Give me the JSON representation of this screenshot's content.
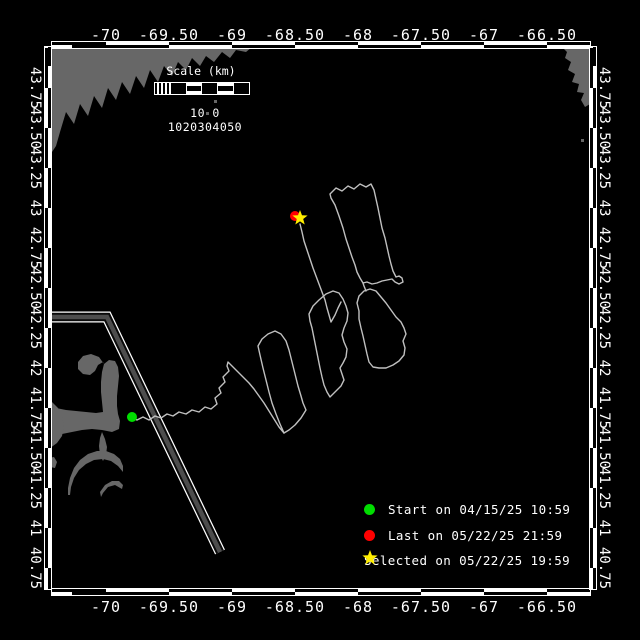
{
  "figure": {
    "background": "#000000",
    "frame_color": "#ffffff",
    "land_color": "#676767",
    "track_color": "#c0c0c0",
    "lane_color": "#4d4d4d",
    "start_color": "#00dd00",
    "last_color": "#ff0000",
    "selected_color": "#ffee00"
  },
  "axes": {
    "lon_ticks": [
      {
        "label": "-70",
        "x": 106
      },
      {
        "label": "-69.50",
        "x": 169
      },
      {
        "label": "-69",
        "x": 232
      },
      {
        "label": "-68.50",
        "x": 295
      },
      {
        "label": "-68",
        "x": 358
      },
      {
        "label": "-67.50",
        "x": 421
      },
      {
        "label": "-67",
        "x": 484
      },
      {
        "label": "-66.50",
        "x": 547
      }
    ],
    "lat_ticks": [
      {
        "label": "43.75",
        "y": 88
      },
      {
        "label": "43.50",
        "y": 128
      },
      {
        "label": "43.25",
        "y": 168
      },
      {
        "label": "43",
        "y": 208
      },
      {
        "label": "42.75",
        "y": 248
      },
      {
        "label": "42.50",
        "y": 288
      },
      {
        "label": "42.25",
        "y": 328
      },
      {
        "label": "42",
        "y": 368
      },
      {
        "label": "41.75",
        "y": 408
      },
      {
        "label": "41.50",
        "y": 448
      },
      {
        "label": "41.25",
        "y": 488
      },
      {
        "label": "41",
        "y": 528
      },
      {
        "label": "40.75",
        "y": 568
      }
    ]
  },
  "scalebar": {
    "title": "Scale (km)",
    "ticks_text": "10 0 1020304050"
  },
  "legend": {
    "entries": [
      {
        "marker": "circle",
        "color": "#00dd00",
        "label": "Start on 04/15/25 10:59"
      },
      {
        "marker": "circle",
        "color": "#ff0000",
        "label": "Last on 05/22/25 21:59"
      },
      {
        "marker": "star",
        "color": "#ffee00",
        "label": "Selected on 05/22/25 19:59"
      }
    ]
  },
  "map": {
    "land_polygons": {
      "maine-coast": [
        [
          52,
          47
        ],
        [
          252,
          47
        ],
        [
          246,
          52
        ],
        [
          236,
          50
        ],
        [
          230,
          58
        ],
        [
          222,
          52
        ],
        [
          214,
          62
        ],
        [
          206,
          56
        ],
        [
          200,
          66
        ],
        [
          192,
          58
        ],
        [
          186,
          70
        ],
        [
          178,
          62
        ],
        [
          172,
          76
        ],
        [
          164,
          66
        ],
        [
          158,
          82
        ],
        [
          150,
          70
        ],
        [
          144,
          88
        ],
        [
          136,
          76
        ],
        [
          130,
          94
        ],
        [
          122,
          82
        ],
        [
          116,
          100
        ],
        [
          108,
          88
        ],
        [
          102,
          108
        ],
        [
          94,
          96
        ],
        [
          88,
          116
        ],
        [
          80,
          104
        ],
        [
          74,
          124
        ],
        [
          66,
          112
        ],
        [
          60,
          132
        ],
        [
          56,
          146
        ],
        [
          52,
          152
        ]
      ],
      "nova-scotia": [
        [
          562,
          47
        ],
        [
          590,
          47
        ],
        [
          590,
          104
        ],
        [
          585,
          107
        ],
        [
          581,
          100
        ],
        [
          584,
          93
        ],
        [
          577,
          92
        ],
        [
          579,
          84
        ],
        [
          572,
          82
        ],
        [
          575,
          74
        ],
        [
          568,
          70
        ],
        [
          571,
          62
        ],
        [
          565,
          58
        ],
        [
          567,
          52
        ]
      ],
      "cape-cod-arm": [
        [
          45,
          406
        ],
        [
          56,
          408
        ],
        [
          66,
          410
        ],
        [
          76,
          411
        ],
        [
          86,
          412
        ],
        [
          96,
          413
        ],
        [
          103,
          412
        ],
        [
          102,
          402
        ],
        [
          101,
          392
        ],
        [
          101,
          382
        ],
        [
          102,
          372
        ],
        [
          104,
          364
        ],
        [
          109,
          360
        ],
        [
          115,
          361
        ],
        [
          118,
          367
        ],
        [
          119,
          376
        ],
        [
          118,
          386
        ],
        [
          117,
          396
        ],
        [
          117,
          406
        ],
        [
          118,
          414
        ],
        [
          120,
          421
        ],
        [
          119,
          429
        ],
        [
          112,
          432
        ],
        [
          102,
          430
        ],
        [
          92,
          429
        ],
        [
          82,
          430
        ],
        [
          72,
          432
        ],
        [
          62,
          434
        ],
        [
          52,
          434
        ],
        [
          45,
          432
        ]
      ],
      "provincetown-hook": [
        [
          104,
          364
        ],
        [
          99,
          357
        ],
        [
          91,
          354
        ],
        [
          83,
          356
        ],
        [
          78,
          362
        ],
        [
          78,
          369
        ],
        [
          83,
          374
        ],
        [
          90,
          375
        ],
        [
          95,
          371
        ],
        [
          98,
          365
        ],
        [
          103,
          362
        ]
      ],
      "mainland-shore": [
        [
          45,
          398
        ],
        [
          52,
          402
        ],
        [
          58,
          408
        ],
        [
          62,
          416
        ],
        [
          64,
          426
        ],
        [
          62,
          436
        ],
        [
          57,
          443
        ],
        [
          50,
          448
        ],
        [
          45,
          450
        ]
      ],
      "monomoy": [
        [
          102,
          432
        ],
        [
          105,
          439
        ],
        [
          107,
          447
        ],
        [
          106,
          455
        ],
        [
          103,
          461
        ],
        [
          100,
          455
        ],
        [
          99,
          446
        ],
        [
          100,
          438
        ]
      ],
      "island-arc": [
        [
          68,
          488
        ],
        [
          70,
          478
        ],
        [
          74,
          468
        ],
        [
          80,
          460
        ],
        [
          88,
          454
        ],
        [
          97,
          451
        ],
        [
          106,
          451
        ],
        [
          114,
          454
        ],
        [
          120,
          459
        ],
        [
          123,
          466
        ],
        [
          123,
          472
        ],
        [
          118,
          466
        ],
        [
          111,
          461
        ],
        [
          103,
          459
        ],
        [
          94,
          460
        ],
        [
          86,
          464
        ],
        [
          79,
          470
        ],
        [
          74,
          478
        ],
        [
          71,
          487
        ],
        [
          70,
          495
        ],
        [
          68,
          495
        ]
      ],
      "island-arc-2": [
        [
          100,
          492
        ],
        [
          105,
          485
        ],
        [
          112,
          481
        ],
        [
          119,
          481
        ],
        [
          123,
          485
        ],
        [
          122,
          489
        ],
        [
          115,
          485
        ],
        [
          108,
          487
        ],
        [
          103,
          493
        ],
        [
          101,
          497
        ]
      ],
      "islet": [
        [
          49,
          458
        ],
        [
          54,
          457
        ],
        [
          57,
          462
        ],
        [
          55,
          468
        ],
        [
          50,
          467
        ],
        [
          48,
          462
        ]
      ]
    },
    "islets": [
      [
        214,
        100
      ],
      [
        228,
        92
      ],
      [
        206,
        112
      ],
      [
        581,
        139
      ]
    ],
    "lane": [
      [
        52,
        317
      ],
      [
        107,
        317
      ],
      [
        220,
        552
      ]
    ],
    "track_paths": {
      "transit": [
        [
          132,
          417
        ],
        [
          137,
          420
        ],
        [
          143,
          417
        ],
        [
          149,
          420
        ],
        [
          155,
          416
        ],
        [
          161,
          418
        ],
        [
          167,
          414
        ],
        [
          173,
          416
        ],
        [
          179,
          412
        ],
        [
          186,
          414
        ],
        [
          192,
          410
        ],
        [
          199,
          412
        ],
        [
          205,
          407
        ],
        [
          211,
          409
        ],
        [
          217,
          404
        ],
        [
          215,
          398
        ],
        [
          221,
          393
        ],
        [
          219,
          388
        ],
        [
          225,
          382
        ],
        [
          223,
          377
        ],
        [
          229,
          371
        ],
        [
          227,
          366
        ],
        [
          228,
          362
        ],
        [
          233,
          367
        ],
        [
          238,
          372
        ],
        [
          243,
          377
        ],
        [
          249,
          383
        ],
        [
          254,
          389
        ],
        [
          259,
          396
        ],
        [
          264,
          403
        ],
        [
          269,
          411
        ],
        [
          274,
          419
        ],
        [
          279,
          427
        ],
        [
          284,
          433
        ]
      ],
      "loop1": [
        [
          284,
          433
        ],
        [
          280,
          424
        ],
        [
          276,
          414
        ],
        [
          272,
          403
        ],
        [
          269,
          392
        ],
        [
          266,
          380
        ],
        [
          263,
          368
        ],
        [
          260,
          355
        ],
        [
          258,
          346
        ],
        [
          262,
          339
        ],
        [
          268,
          334
        ],
        [
          275,
          331
        ],
        [
          281,
          334
        ],
        [
          286,
          341
        ],
        [
          289,
          350
        ],
        [
          292,
          362
        ],
        [
          295,
          374
        ],
        [
          298,
          386
        ],
        [
          301,
          396
        ],
        [
          303,
          403
        ],
        [
          306,
          410
        ],
        [
          301,
          418
        ],
        [
          295,
          425
        ],
        [
          289,
          430
        ],
        [
          284,
          433
        ]
      ],
      "loop2": [
        [
          309,
          314
        ],
        [
          313,
          306
        ],
        [
          319,
          300
        ],
        [
          326,
          294
        ],
        [
          333,
          291
        ],
        [
          339,
          293
        ],
        [
          343,
          299
        ],
        [
          346,
          306
        ],
        [
          348,
          313
        ],
        [
          347,
          321
        ],
        [
          344,
          328
        ],
        [
          342,
          335
        ],
        [
          344,
          342
        ],
        [
          347,
          349
        ],
        [
          346,
          357
        ],
        [
          343,
          363
        ],
        [
          340,
          368
        ],
        [
          342,
          374
        ],
        [
          344,
          380
        ],
        [
          341,
          386
        ],
        [
          337,
          390
        ],
        [
          333,
          394
        ],
        [
          330,
          397
        ],
        [
          327,
          392
        ],
        [
          324,
          385
        ],
        [
          322,
          377
        ],
        [
          320,
          368
        ],
        [
          318,
          358
        ],
        [
          316,
          348
        ],
        [
          314,
          338
        ],
        [
          312,
          328
        ],
        [
          310,
          321
        ],
        [
          309,
          314
        ]
      ],
      "loop3": [
        [
          359,
          311
        ],
        [
          357,
          303
        ],
        [
          359,
          296
        ],
        [
          364,
          291
        ],
        [
          370,
          289
        ],
        [
          376,
          291
        ],
        [
          381,
          297
        ],
        [
          386,
          303
        ],
        [
          391,
          310
        ],
        [
          396,
          317
        ],
        [
          401,
          322
        ],
        [
          404,
          328
        ],
        [
          406,
          334
        ],
        [
          403,
          341
        ],
        [
          405,
          348
        ],
        [
          404,
          355
        ],
        [
          399,
          361
        ],
        [
          393,
          365
        ],
        [
          386,
          368
        ],
        [
          379,
          368
        ],
        [
          373,
          367
        ],
        [
          369,
          362
        ],
        [
          367,
          354
        ],
        [
          365,
          345
        ],
        [
          363,
          336
        ],
        [
          361,
          328
        ],
        [
          359,
          319
        ],
        [
          359,
          311
        ]
      ],
      "east-loop": [
        [
          330,
          194
        ],
        [
          336,
          188
        ],
        [
          342,
          191
        ],
        [
          348,
          186
        ],
        [
          354,
          189
        ],
        [
          360,
          184
        ],
        [
          366,
          187
        ],
        [
          371,
          184
        ],
        [
          374,
          190
        ],
        [
          376,
          199
        ],
        [
          378,
          208
        ],
        [
          380,
          218
        ],
        [
          382,
          228
        ],
        [
          385,
          238
        ],
        [
          387,
          247
        ],
        [
          389,
          256
        ],
        [
          391,
          264
        ],
        [
          393,
          271
        ],
        [
          396,
          277
        ],
        [
          399,
          276
        ],
        [
          402,
          278
        ],
        [
          403,
          282
        ],
        [
          399,
          284
        ],
        [
          395,
          282
        ],
        [
          392,
          279
        ],
        [
          387,
          280
        ],
        [
          382,
          281
        ],
        [
          377,
          283
        ],
        [
          372,
          284
        ],
        [
          367,
          282
        ],
        [
          363,
          283
        ],
        [
          360,
          278
        ],
        [
          357,
          272
        ],
        [
          355,
          265
        ],
        [
          352,
          257
        ],
        [
          349,
          248
        ],
        [
          346,
          239
        ],
        [
          343,
          228
        ],
        [
          339,
          216
        ],
        [
          335,
          205
        ],
        [
          331,
          198
        ],
        [
          330,
          194
        ]
      ],
      "star-leg": [
        [
          300,
          224
        ],
        [
          302,
          232
        ],
        [
          304,
          241
        ],
        [
          307,
          250
        ],
        [
          310,
          259
        ],
        [
          313,
          268
        ],
        [
          316,
          276
        ],
        [
          319,
          284
        ],
        [
          322,
          292
        ],
        [
          325,
          300
        ],
        [
          327,
          308
        ],
        [
          329,
          315
        ],
        [
          331,
          322
        ],
        [
          335,
          315
        ],
        [
          338,
          308
        ],
        [
          341,
          302
        ]
      ],
      "connector": [
        [
          366,
          291
        ],
        [
          364,
          286
        ],
        [
          363,
          283
        ]
      ]
    },
    "markers": {
      "start": {
        "x": 132,
        "y": 417,
        "r": 5
      },
      "last": {
        "x": 295,
        "y": 216,
        "r": 5
      },
      "selected": {
        "x": 300,
        "y": 218,
        "r": 8
      }
    }
  }
}
